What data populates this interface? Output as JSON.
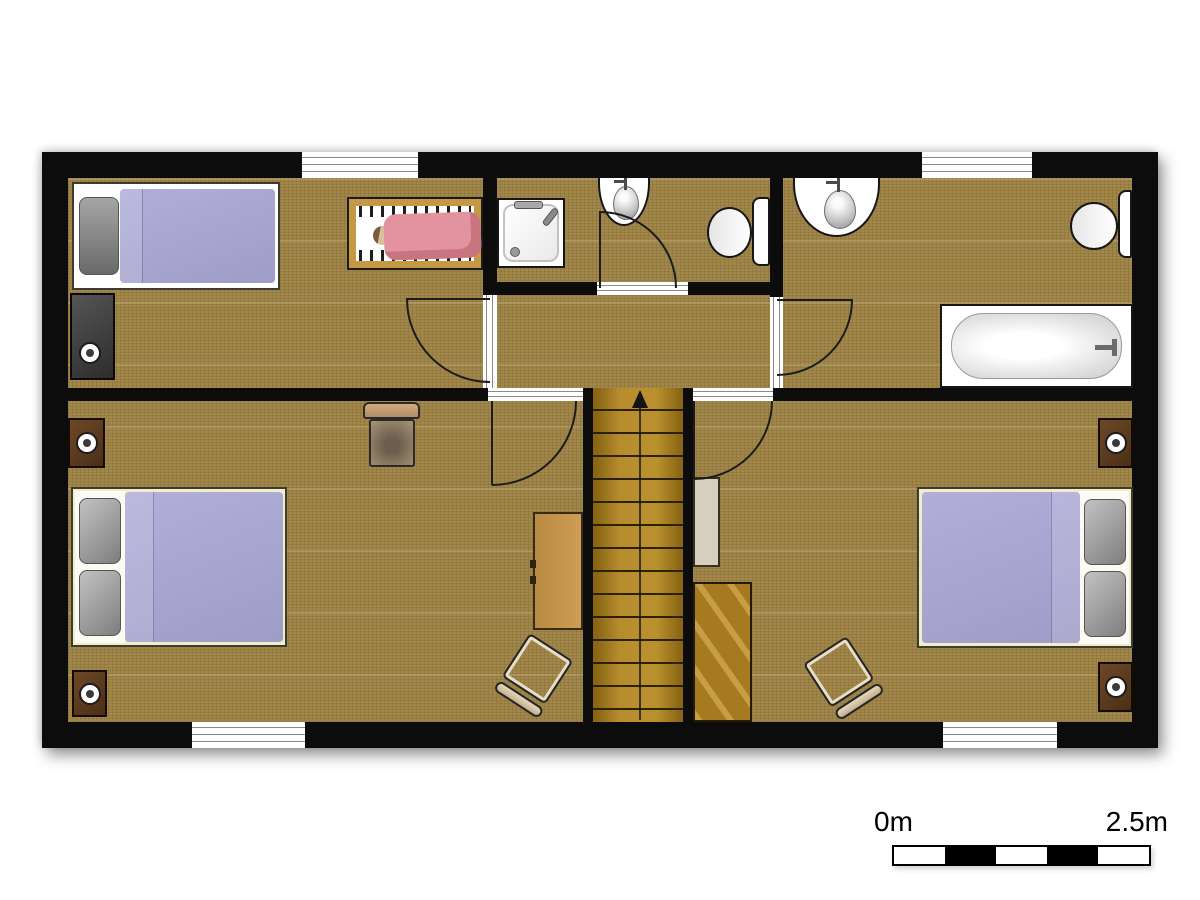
{
  "scale_bar": {
    "start_label": "0m",
    "end_label": "2.5m",
    "segments": [
      "#ffffff",
      "#000000",
      "#ffffff",
      "#000000",
      "#ffffff"
    ]
  },
  "palette": {
    "wall": "#0c0c0c",
    "carpet": "#a1874a",
    "stair_wood": "#a87c1d",
    "duvet_lavender": "#a8a5d3",
    "bed_frame_cream": "#f1edca",
    "pillow_gray": "#9a9a9a",
    "crib_wood": "#c59845",
    "baby_blanket_pink": "#e2939f",
    "nightstand_brown": "#5e3d20",
    "desk_wood": "#c49148",
    "wardrobe_beige": "#d8cec0",
    "dresser_dark": "#3e3e3e",
    "fixture_white": "#ffffff",
    "fixture_outline": "#161616"
  }
}
